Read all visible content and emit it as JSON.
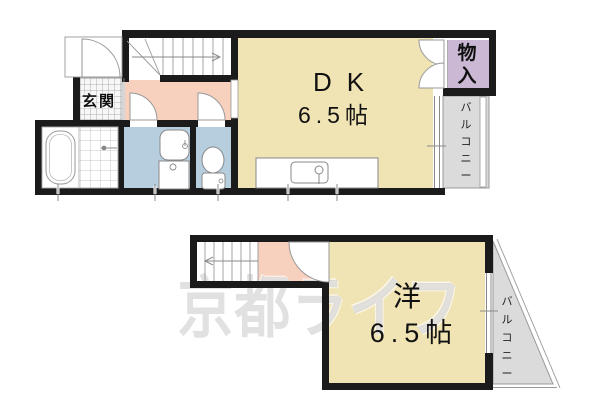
{
  "watermark": "京都ライフ",
  "colors": {
    "wall": "#1b1b1b",
    "room": "#F0E3B4",
    "hall": "#F8D1BE",
    "wet": "#B7CEDF",
    "closet": "#CBB8D5",
    "balcony": "#DBDBDB"
  },
  "floor1": {
    "entrance_label": "玄関",
    "dk_label": "DK",
    "dk_size": "6.5帖",
    "closet_label": "物入",
    "balcony_label": "バルコニー"
  },
  "floor2": {
    "room_label": "洋",
    "room_size": "6.5帖",
    "balcony_label": "バルコニー"
  }
}
